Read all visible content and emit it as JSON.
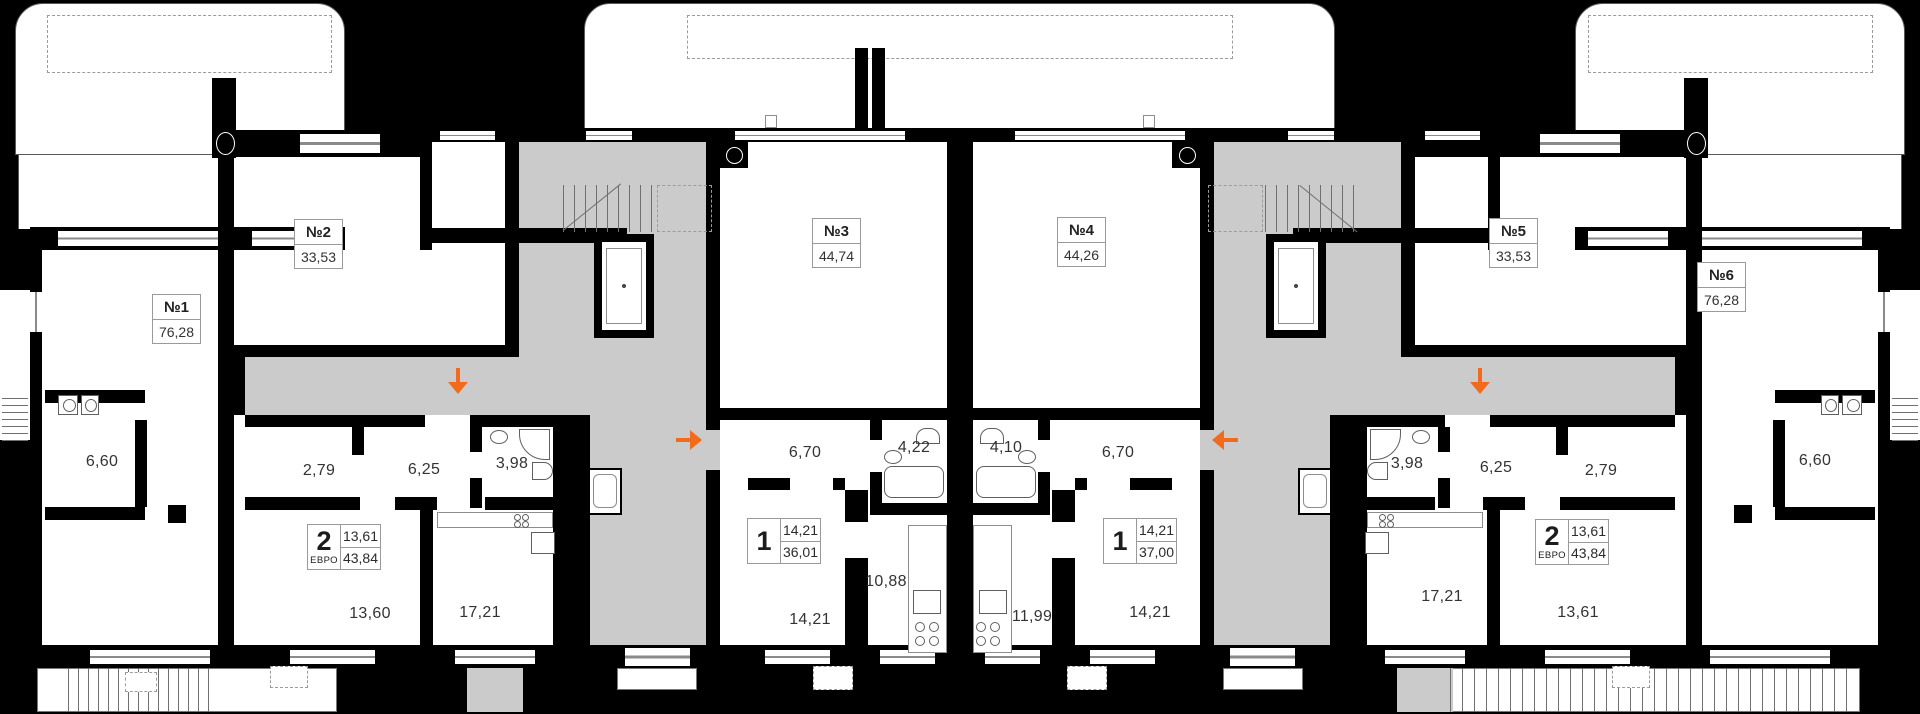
{
  "title": "Floor plan with 6 units",
  "colors": {
    "background": "#000000",
    "walls": "#000000",
    "floor": "#ffffff",
    "common_area": "#cbcbcb",
    "entrance_arrow": "#f26b1d",
    "label_text": "#333333"
  },
  "units": [
    {
      "number": "№1",
      "area": "76,28"
    },
    {
      "number": "№2",
      "area": "33,53"
    },
    {
      "number": "№3",
      "area": "44,74"
    },
    {
      "number": "№4",
      "area": "44,26"
    },
    {
      "number": "№5",
      "area": "33,53"
    },
    {
      "number": "№6",
      "area": "76,28"
    }
  ],
  "apartments": [
    {
      "rooms": "2",
      "type": "ЕВРО",
      "living_area": "13,61",
      "total_area": "43,84"
    },
    {
      "rooms": "1",
      "type": "",
      "living_area": "14,21",
      "total_area": "36,01"
    },
    {
      "rooms": "1",
      "type": "",
      "living_area": "14,21",
      "total_area": "37,00"
    },
    {
      "rooms": "2",
      "type": "ЕВРО",
      "living_area": "13,61",
      "total_area": "43,84"
    }
  ],
  "room_labels": [
    {
      "area": "6,60"
    },
    {
      "area": "2,79"
    },
    {
      "area": "6,25"
    },
    {
      "area": "3,98"
    },
    {
      "area": "13,60"
    },
    {
      "area": "17,21"
    },
    {
      "area": "6,70"
    },
    {
      "area": "4,22"
    },
    {
      "area": "14,21"
    },
    {
      "area": "10,88"
    },
    {
      "area": "4,10"
    },
    {
      "area": "6,70"
    },
    {
      "area": "11,99"
    },
    {
      "area": "14,21"
    },
    {
      "area": "3,98"
    },
    {
      "area": "6,25"
    },
    {
      "area": "2,79"
    },
    {
      "area": "17,21"
    },
    {
      "area": "13,61"
    },
    {
      "area": "6,60"
    }
  ],
  "entrances": [
    {
      "direction": "down"
    },
    {
      "direction": "right"
    },
    {
      "direction": "left"
    },
    {
      "direction": "down"
    }
  ]
}
